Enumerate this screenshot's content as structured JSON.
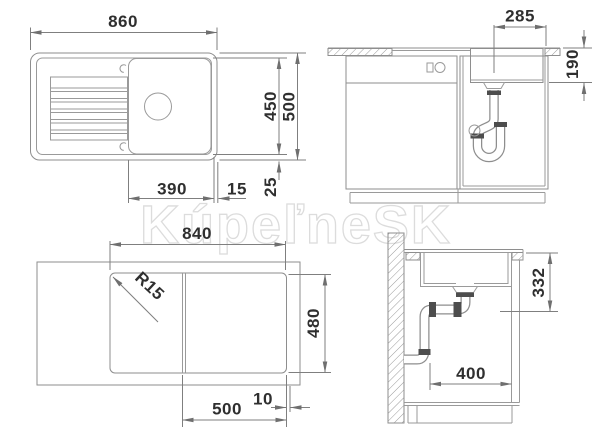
{
  "watermark": {
    "text": "KúpeľneSK"
  },
  "top_view": {
    "width": "860",
    "depth_inner": "450",
    "depth_outer": "500",
    "bowl_width": "390",
    "gap": "15",
    "rim": "25"
  },
  "front_view": {
    "drain_offset": "285",
    "bowl_depth": "190"
  },
  "cutout_view": {
    "width": "840",
    "radius": "R15",
    "depth": "480",
    "bowl_position": "500",
    "margin": "10"
  },
  "section_view": {
    "outlet_height": "332",
    "clearance": "400"
  },
  "colors": {
    "line": "#8e8e8e",
    "text": "#2f2f2f",
    "watermark": "#dcdcdc"
  }
}
